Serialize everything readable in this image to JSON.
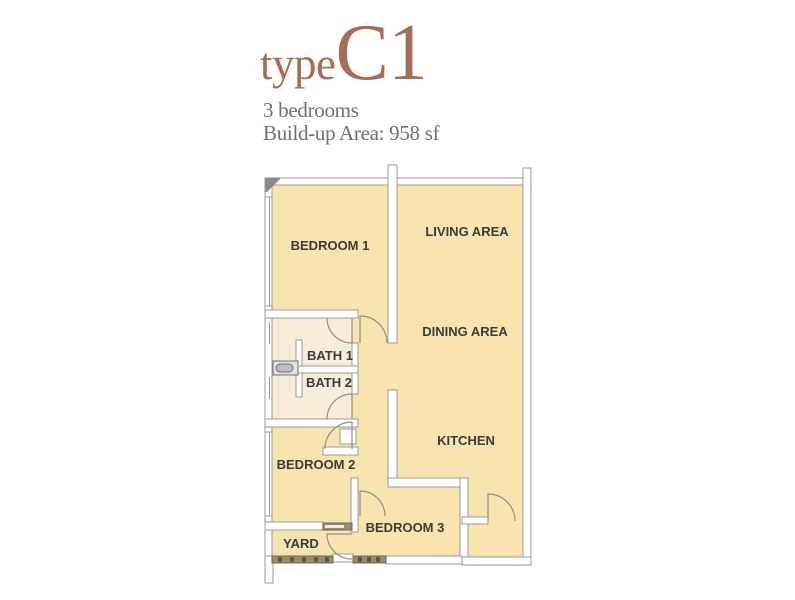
{
  "title": {
    "prefix": "type",
    "code": "C1"
  },
  "subtitle": {
    "line1": "3 bedrooms",
    "line2": "Build-up Area: 958 sf"
  },
  "plan": {
    "rooms": [
      {
        "id": "bedroom-1",
        "label": "BEDROOM 1"
      },
      {
        "id": "living-area",
        "label": "LIVING AREA"
      },
      {
        "id": "dining-area",
        "label": "DINING AREA"
      },
      {
        "id": "bath-1",
        "label": "BATH 1"
      },
      {
        "id": "bath-2",
        "label": "BATH 2"
      },
      {
        "id": "bedroom-2",
        "label": "BEDROOM 2"
      },
      {
        "id": "kitchen",
        "label": "KITCHEN"
      },
      {
        "id": "bedroom-3",
        "label": "BEDROOM 3"
      },
      {
        "id": "yard",
        "label": "YARD"
      }
    ]
  },
  "colors": {
    "accent_brown": "#A56E55",
    "subtitle_gray": "#707070",
    "floor_yellow": "#F8E4AE",
    "floor_pale": "#F7EDD8",
    "wall_stroke": "#9a9a9a",
    "label_text": "#3b3b3b",
    "hatch_tan": "#998E6B"
  }
}
